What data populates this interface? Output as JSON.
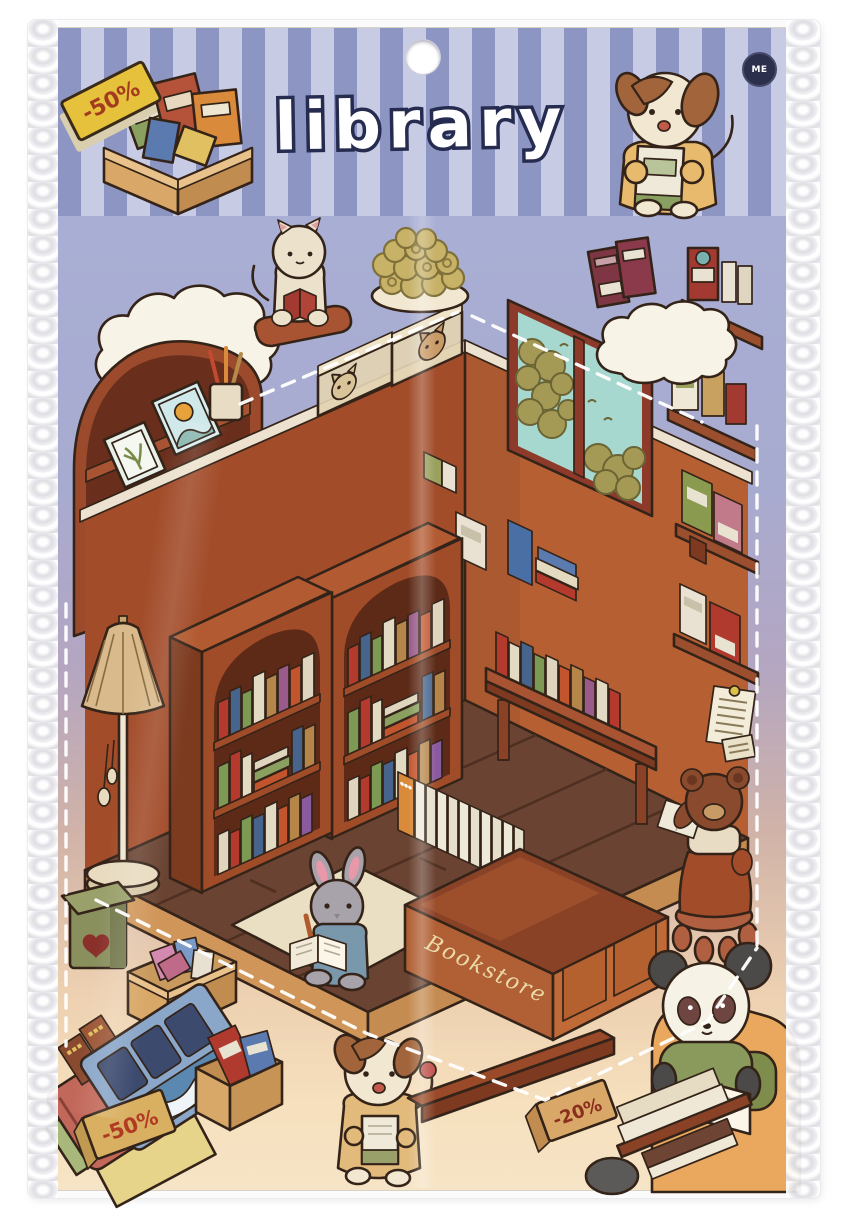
{
  "product": {
    "type": "cute library sticker sheet in clear hanging plastic package",
    "title": "library"
  },
  "header": {
    "title": "library",
    "stripe_light": "#c7cbe3",
    "stripe_dark": "#8d95c3",
    "discount_tag": {
      "label": "-50%",
      "bg": "#e6c23c",
      "text_color": "#a33b20"
    },
    "logo": {
      "text": "ME",
      "bg": "#2c2f4c",
      "text_color": "#ffffff"
    }
  },
  "scene": {
    "bg_top": "#a9aed4",
    "bg_bottom": "#f6e4c6",
    "desk_label": "Bookstore",
    "tag_bottom_left": {
      "label": "-50%",
      "bg": "#d9b062",
      "text_color": "#b03a24"
    },
    "tag_bottom_right": {
      "label": "-20%",
      "bg": "#d9a868",
      "text_color": "#8a2f1e"
    },
    "colors": {
      "wall_left": "#a24c2a",
      "wall_right": "#b65f33",
      "floor": "#6a4332",
      "floor_edge": "#d09659",
      "bookcase": "#a14c29",
      "window_glass": "#a7d8cf",
      "cloud": "#f7f3e6",
      "rug": "#eadfc2"
    },
    "stickers": [
      "box-of-books",
      "discount-tag",
      "dog-reading",
      "cloud",
      "cat-reading-on-stand",
      "cookie-plate",
      "red-books-pair",
      "wall-shelf-with-books",
      "arched-bookshelf",
      "corner-window",
      "storage-boxes-with-cats",
      "bookcase-left",
      "bookcase-right",
      "floor-lamp",
      "bench-with-books",
      "white-books-row",
      "bookstore-counter",
      "rug",
      "rabbit-reading",
      "green-mailbox",
      "box-of-postcards",
      "book-pile-discount",
      "puppy-with-book",
      "wood-plank",
      "bear-on-stool",
      "panda-reading-in-armchair",
      "book-stacks",
      "pinned-note"
    ]
  }
}
